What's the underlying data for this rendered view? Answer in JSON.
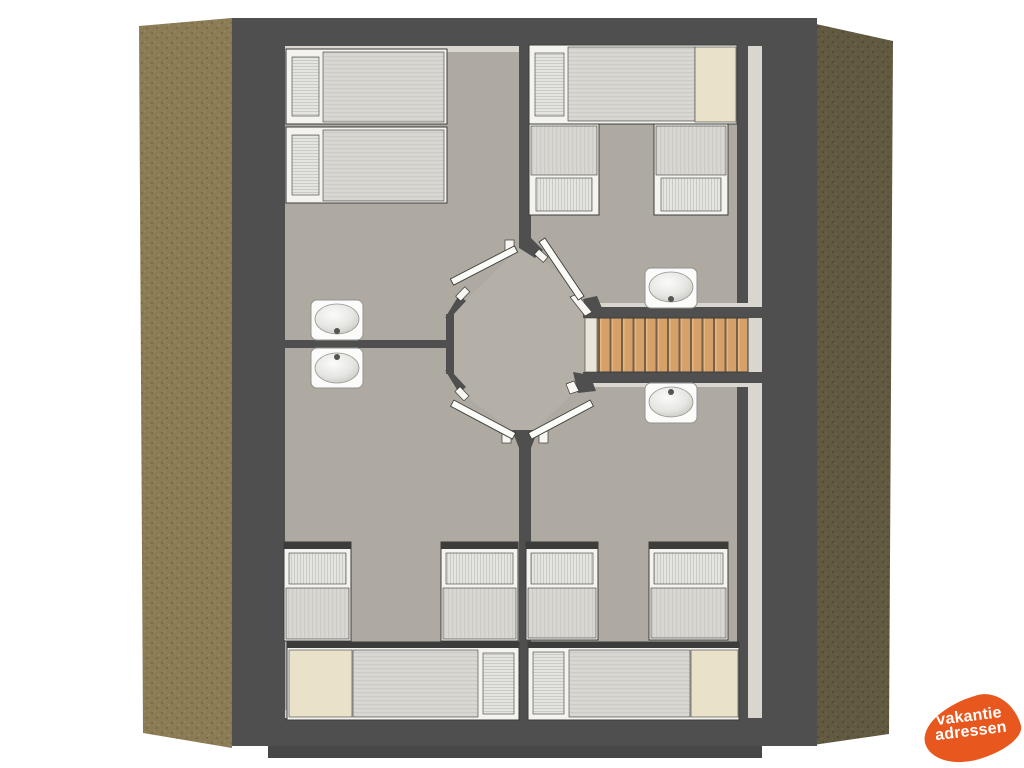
{
  "branding": {
    "logo_line1": "vakantie",
    "logo_line2": "adressen"
  },
  "colors": {
    "background": "#FFFFFF",
    "wall": "#4F4F4F",
    "wall_step": "#474747",
    "outline": "#3C3C3A",
    "floor": "#AEAAA1",
    "hall_floor": "#B4B0A7",
    "highlight": "#D8D6CF",
    "roof_left": "#8C7C55",
    "roof_left_dark": "#7B6B46",
    "roof_left_light": "#99895F",
    "roof_right": "#615940",
    "roof_right_dark": "#534C35",
    "roof_right_light": "#6C634A",
    "wood": "#D5A169",
    "wood_gap": "#77604A",
    "wood_light": "#E3B77F",
    "tread_light": "#E9E5DA",
    "bed_frame": "#F4F3EF",
    "blanket": "#D9D7D1",
    "blanket_stripe": "#CDCBC5",
    "pillow": "#E4E4E1",
    "pillow_stripe": "#CBCBC6",
    "beige": "#E9E1C8",
    "sink": "#FBFBFA",
    "sink_stroke": "#92928E",
    "basin_deep": "#BFBFBC",
    "faucet": "#55554F",
    "logo_orange": "#E8571D",
    "logo_text": "#FFFFFF"
  }
}
